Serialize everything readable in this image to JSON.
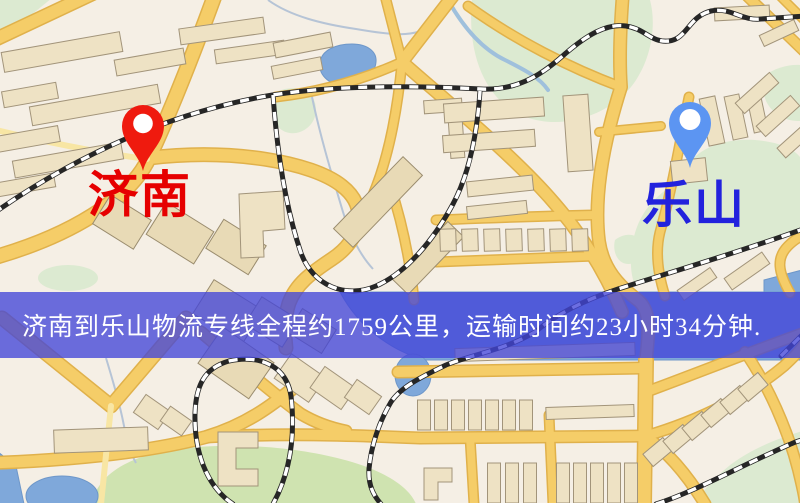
{
  "banner": {
    "text": "济南到乐山物流专线全程约1759公里，运输时间约23小时34分钟.",
    "background_color": "#4345d8",
    "text_color": "#ffffff"
  },
  "markers": {
    "origin": {
      "name": "济南",
      "pin_color": "#ef1a0e",
      "label_color": "#e60000"
    },
    "destination": {
      "name": "乐山",
      "pin_color": "#5c95f2",
      "label_color": "#2222dd"
    }
  },
  "map_palette": {
    "background": "#f5efe5",
    "road": "#f5cd68",
    "road_casing": "#e0b14b",
    "minor_road": "#f8e6a4",
    "water": "#7fa8da",
    "park": "#dcead1",
    "building": "#eee2c4",
    "railway_dash": "#ffffff",
    "railway_base": "#262626"
  }
}
